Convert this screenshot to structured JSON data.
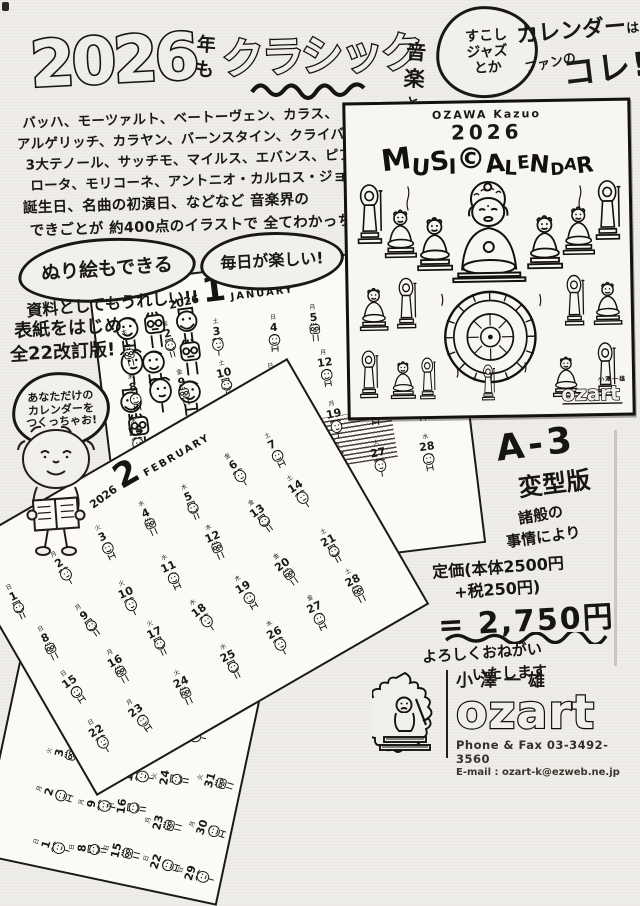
{
  "headline": {
    "year": "2026",
    "year_suffix_1": "年",
    "year_suffix_2": "も",
    "word_classic": "クラシック",
    "music_chars": [
      "音",
      "楽",
      "と"
    ],
    "bubble_lines": [
      "すこし",
      "ジャズ",
      "とか"
    ],
    "word_calendar": "カレンダー",
    "particle_wa": "は",
    "word_fan": "ファンの",
    "word_kore": "コレ!"
  },
  "intro": {
    "lines": [
      "バッハ、モーツァルト、ベートーヴェン、カラス、",
      "アルゲリッチ、カラヤン、バーンスタイン、クライバー、",
      "3大テノール、サッチモ、マイルス、エバンス、ピアソラ",
      "ロータ、モリコーネ、アントニオ・カルロス・ジョビン たちの",
      "誕生日、名曲の初演日、などなど 音楽界の",
      "できごとが 約400点のイラストで 全てわかっちゃう!"
    ]
  },
  "callouts": {
    "coloring": "ぬり絵もできる",
    "fun": "毎日が楽しい!",
    "reference": "資料としてもうれしい!!",
    "revision_line1": "表紙をはじめ",
    "revision_line2": "全22改訂版!",
    "your_own_lines": [
      "あなただけの",
      "カレンダーを",
      "つくっちゃお!"
    ]
  },
  "poster": {
    "author": "OZAWA Kazuo",
    "year": "2026",
    "title": "MUSIC CALENDAR",
    "title_letters": [
      "M",
      "U",
      "S",
      "I",
      "©",
      "A",
      "L",
      "E",
      "N",
      "D",
      "A",
      "R"
    ],
    "logo_kanji": "小澤一雄",
    "logo": "ozart"
  },
  "sheets": [
    {
      "year": "2026",
      "num": "1",
      "name": "JANUARY",
      "days": 31,
      "start_weekday": 4
    },
    {
      "year": "2026",
      "num": "2",
      "name": "FEBRUARY",
      "days": 28,
      "start_weekday": 0
    },
    {
      "year": "2026",
      "num": "3",
      "name": "MARCH",
      "days": 31,
      "start_weekday": 0
    }
  ],
  "weekdays": [
    "日",
    "月",
    "火",
    "水",
    "木",
    "金",
    "土"
  ],
  "offer": {
    "size_line1": "A-3",
    "size_line2": "変型版",
    "note_line1": "諸般の",
    "note_line2": "事情により",
    "price_line1": "定価(本体2500円",
    "price_line2": "+税250円)",
    "price_total": "= 2,750円",
    "closing_line1": "よろしくおねがい",
    "closing_line2": "いたします"
  },
  "footer": {
    "name_kanji": "小澤一雄",
    "logo": "ozart",
    "phone": "Phone & Fax 03-3492-3560",
    "email": "E-mail : ozart-k@ezweb.ne.jp"
  },
  "colors": {
    "ink": "#1a1816",
    "paper": "#efede9",
    "sheet": "#fbfaf7"
  }
}
